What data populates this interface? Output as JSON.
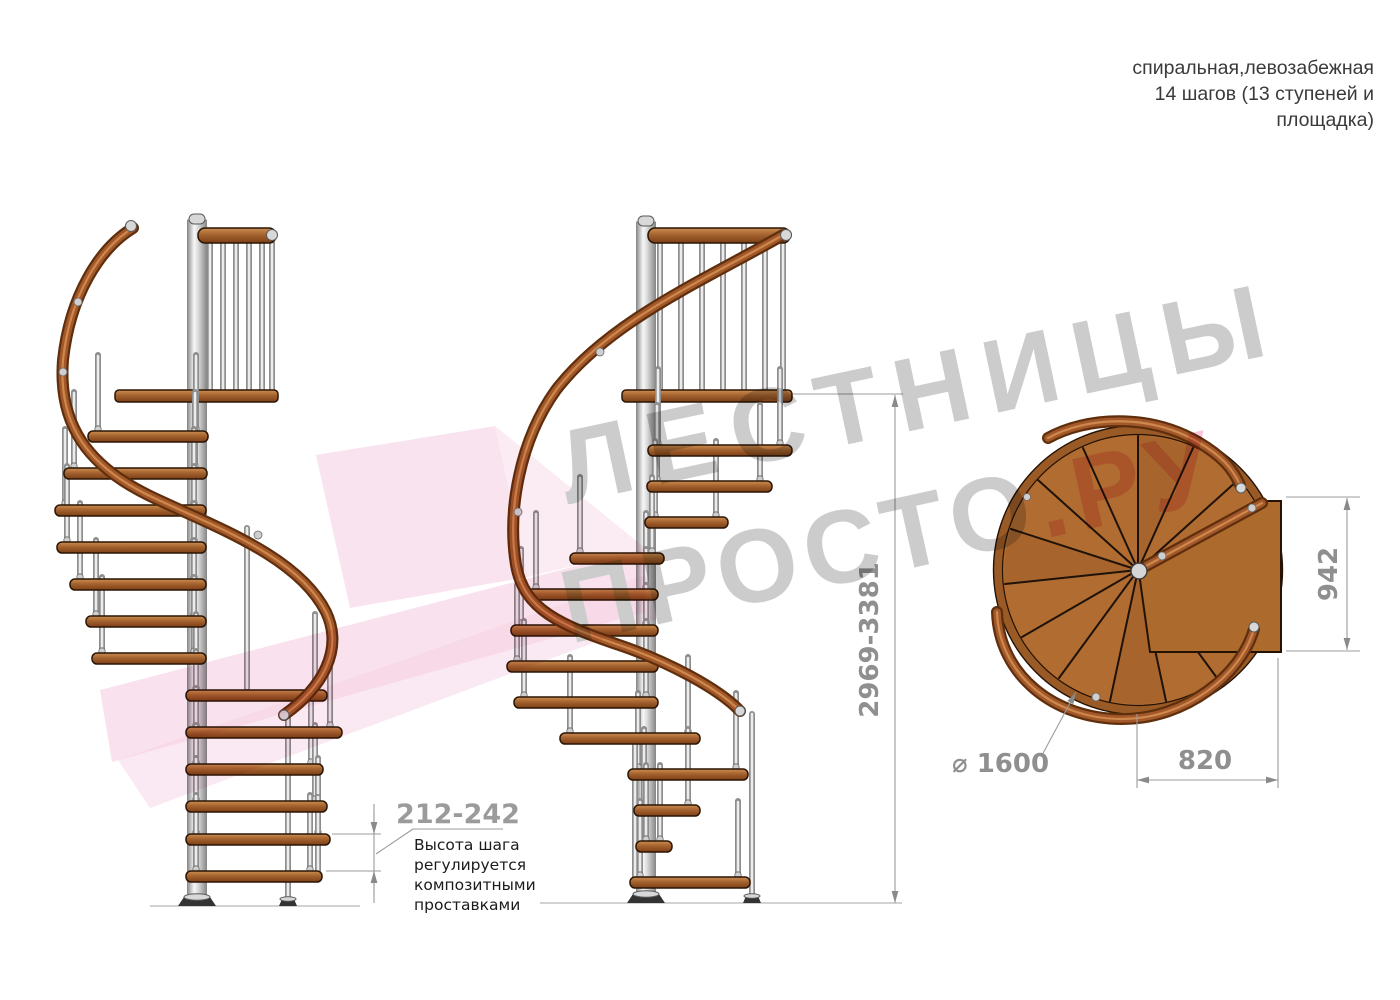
{
  "header": {
    "line1": "спиральная,левозабежная",
    "line2": "14 шагов (13 ступеней и",
    "line3": "площадка)"
  },
  "dimensions": {
    "total_height": "2969-3381",
    "step_height": "212-242",
    "landing_depth": "942",
    "entry_width": "820",
    "diameter": "⌀ 1600"
  },
  "step_note": {
    "line1": "Высота шага",
    "line2": "регулируется",
    "line3": "композитными",
    "line4": "проставками"
  },
  "watermark": {
    "line1": "ЛЕСТНИЦЫ",
    "line2_gray": "ПРОСТО",
    "line2_pink": ".РУ"
  },
  "structure": {
    "steps_per_flight": 13,
    "views": [
      "side-elevation-front",
      "side-elevation-side",
      "top-plan"
    ]
  },
  "colors": {
    "wood": "#a8622c",
    "rail": "#a3582a",
    "steel": "#d8d8d8",
    "dim": "#8f8f8f",
    "line": "#9b9b9b",
    "note": "#1b1b1b",
    "wmGray": "#9a9a9a",
    "wmPink": "#ee8fb8",
    "shapePink": "#eda3c9",
    "titleInk": "#3a3a3a"
  }
}
